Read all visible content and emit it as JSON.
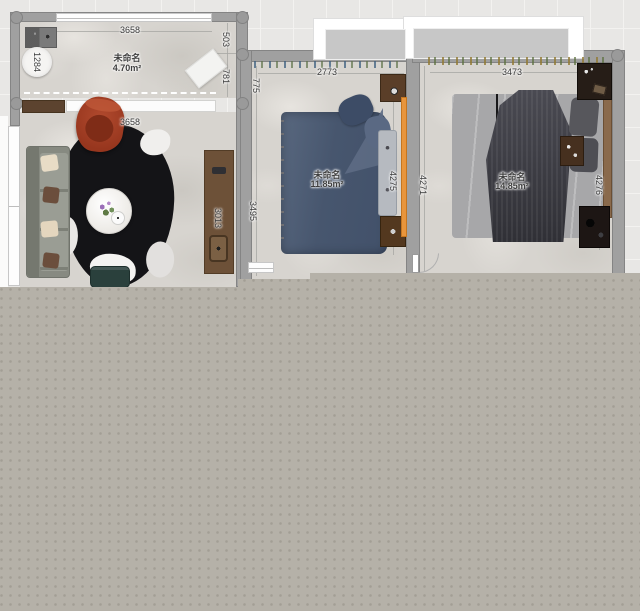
{
  "plan": {
    "balcony": {
      "name": "未命名",
      "area": "4.70m²",
      "dim_top": "3658",
      "dim_left": "1284",
      "dim_right_upper": "503",
      "dim_right_lower": "781"
    },
    "living": {
      "dim_top": "3658",
      "dim_right": "3013"
    },
    "bedroom_mid": {
      "name": "未命名",
      "area": "11.85m²",
      "dim_top": "2773",
      "dim_left_upper": "775",
      "dim_left_lower": "3495",
      "dim_right": "4275"
    },
    "bedroom_right": {
      "name": "未命名",
      "area": "14.85m²",
      "dim_top": "3473",
      "dim_left": "4271",
      "dim_right": "4276"
    }
  },
  "colors": {
    "canvas_bg": "#e8e7e5",
    "overlay": "#b5b1a8",
    "wall": "#a0a0a0",
    "bed_mid_blue": "#46566d",
    "bed_right_duvet": "#3e3e44",
    "wardrobe_orange": "#e8953c",
    "armchair_red": "#a8422a",
    "rug_black": "#141417"
  }
}
